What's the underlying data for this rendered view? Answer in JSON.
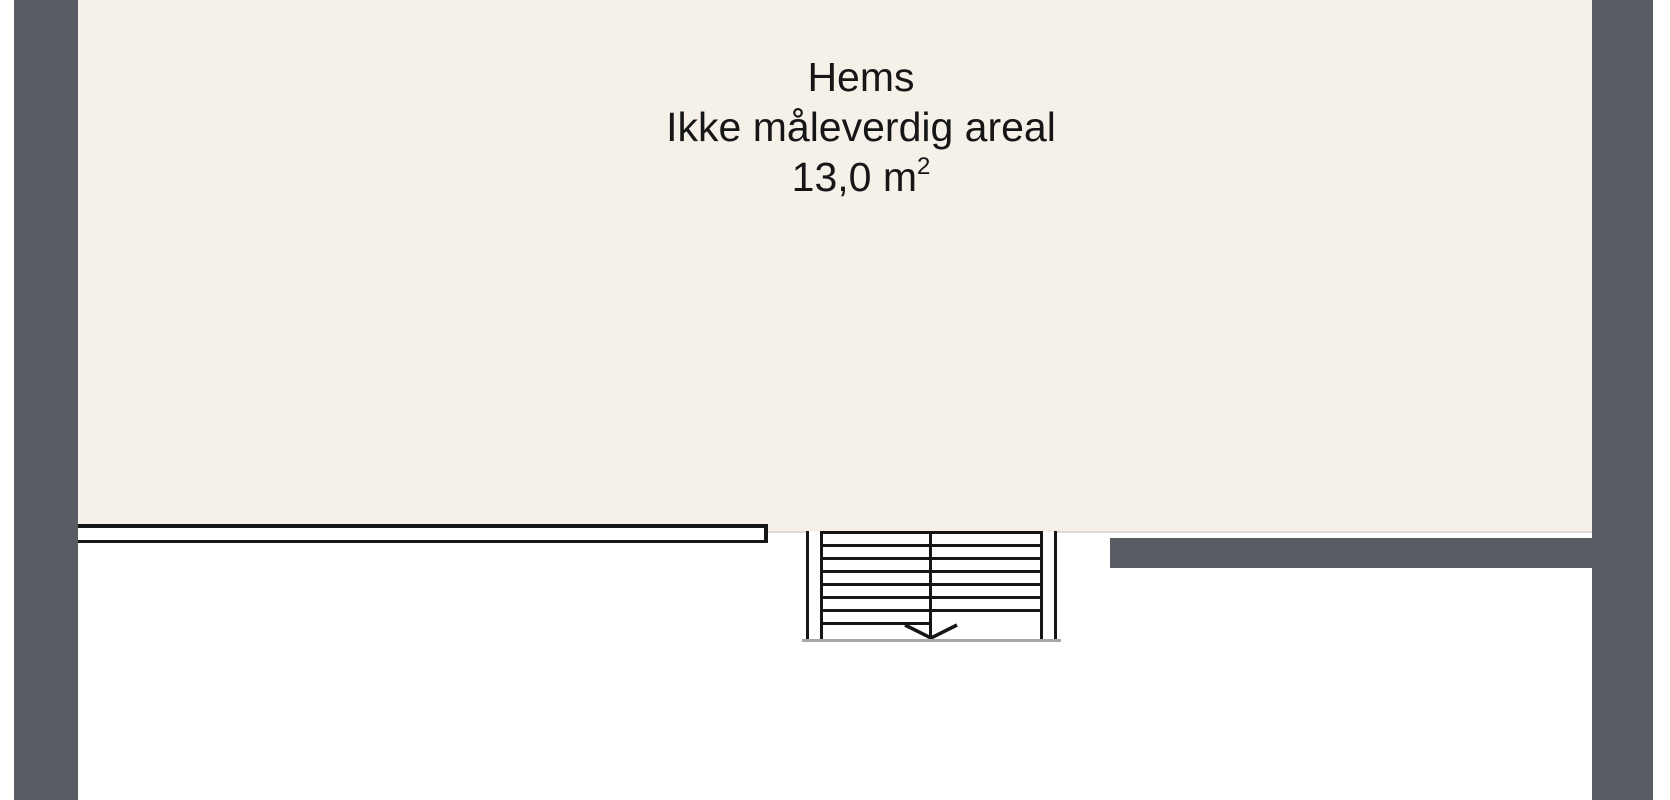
{
  "floorplan": {
    "room": {
      "name": "Hems",
      "note": "Ikke måleverdig areal",
      "area_value": "13,0 m",
      "area_exponent": "2"
    },
    "symbols": {
      "stair_direction": "down"
    },
    "colors": {
      "wall": "#595c63",
      "floor": "#f5f1e9",
      "line": "#161616",
      "background": "#ffffff",
      "stair_shadow": "#a8a8a8"
    }
  }
}
